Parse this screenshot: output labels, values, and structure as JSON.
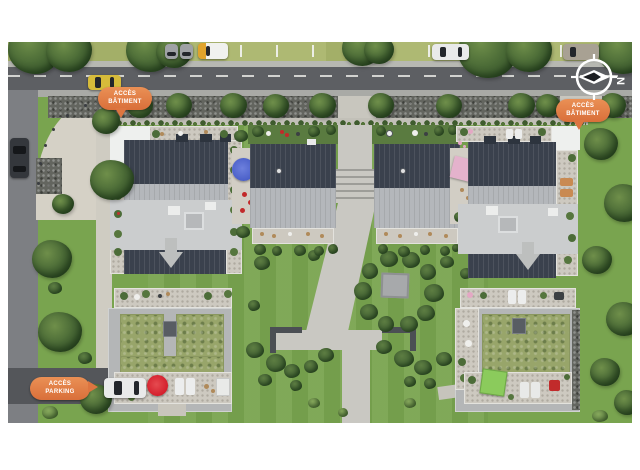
{
  "labels": {
    "access_building_left": {
      "line1": "ACCÈS",
      "line2": "BÂTIMENT"
    },
    "access_building_right": {
      "line1": "ACCÈS",
      "line2": "BÂTIMENT"
    },
    "access_parking": {
      "line1": "ACCÈS",
      "line2": "PARKING"
    }
  },
  "compass": {
    "north": "N"
  },
  "colors": {
    "badge_orange": "#dd7540",
    "asphalt_street": "#5d5f63",
    "side_street": "#7d7f83",
    "sidewalk": "#d5d1c6",
    "gravel_bed": "#63655f",
    "lawn_green": "#79a44f",
    "verge_grass": "#a3af68",
    "roof_dark": "#3a414d",
    "roof_flat": "#cbcdce",
    "sedum_roof": "#98a56a",
    "umbrella_blue": "#4a5fc8",
    "umbrella_pink": "#e4b2cc",
    "umbrella_red": "#d41f2c",
    "canopy_green": "#8bcb5c"
  }
}
